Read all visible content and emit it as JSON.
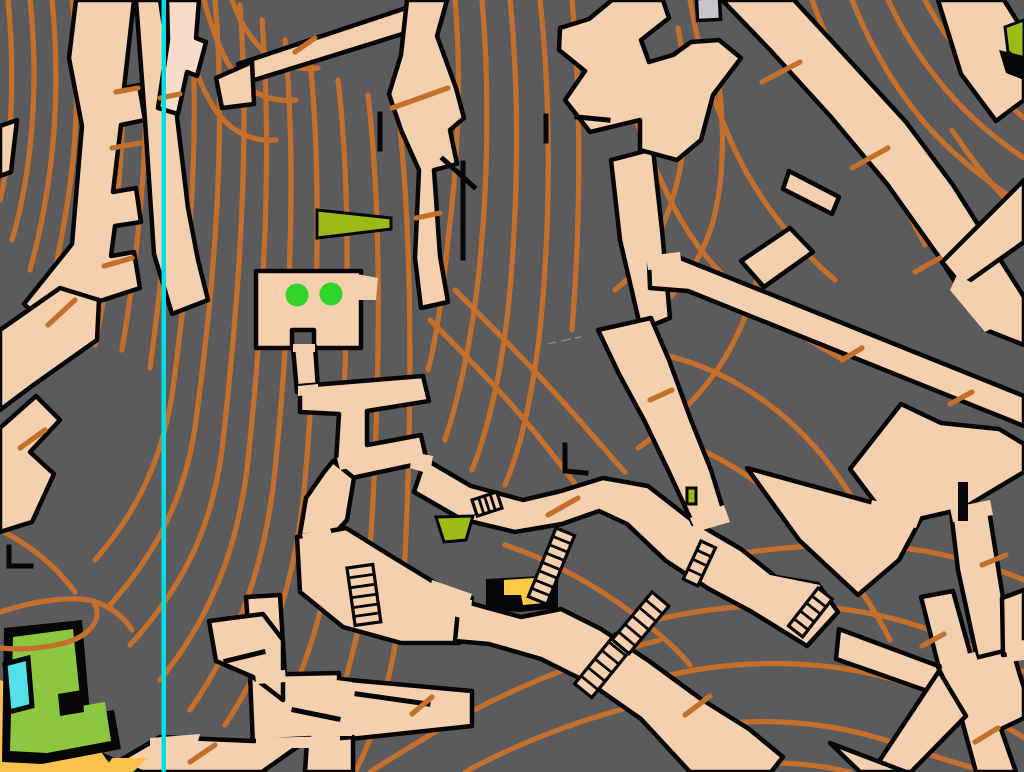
{
  "map": {
    "kind": "sprint-orienteering-street-map",
    "area_description": "Dense urban hillside: dark-grey building blocks, tan paved streets and plazas bounded by black walls, brown contour lines, stairways, trees and vegetation patches",
    "north_line": {
      "orientation": "vertical",
      "x_position": 163,
      "meaning": "magnetic north line"
    },
    "features": {
      "tree_dots": {
        "count": 2,
        "symbol": "green-circle"
      },
      "stair_flights": {
        "count": 7,
        "symbol": "striped-steps"
      },
      "olive_patches": {
        "count": 4,
        "symbol": "olive-green-area"
      },
      "water_pool": {
        "count": 1,
        "symbol": "light-blue-area"
      },
      "grey_building": {
        "count": 1,
        "symbol": "light-grey-rect"
      },
      "yellow_canopy": {
        "count": 1,
        "symbol": "yellow-area-black-edge"
      },
      "open_land": {
        "count": 2,
        "symbol": "yellow-area"
      }
    },
    "colors": {
      "canvas": "#5b5b5d",
      "paved": "#f5d0af",
      "paved_light": "#f8dcc9",
      "contour": "#c46f2b",
      "wall": "#060606",
      "north_line": "#00dde3",
      "tree_green": "#2fd32a",
      "olive": "#9cbb17",
      "vegetation_green": "#8dc63f",
      "water": "#52e1e7",
      "open_yellow": "#fdc24d",
      "canopy_yellow": "#ffc845",
      "building_gray": "#c6c6cc"
    }
  }
}
